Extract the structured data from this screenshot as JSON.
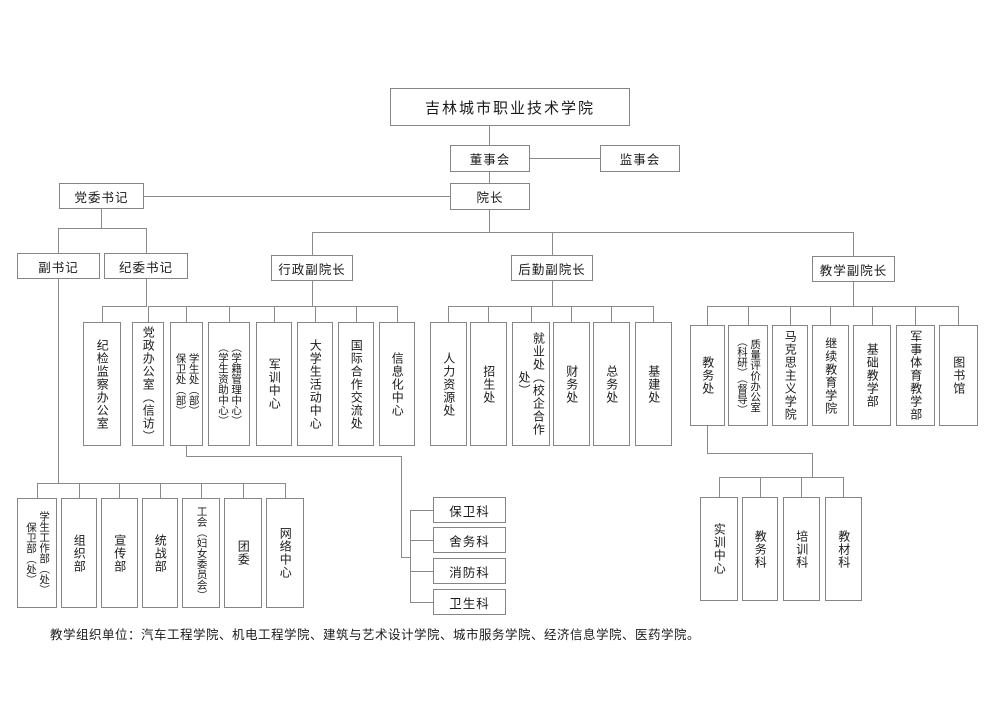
{
  "title": "吉林城市职业技术学院",
  "colors": {
    "line": "#8a8a8a",
    "text": "#1a1a1a",
    "background": "#ffffff"
  },
  "top": {
    "board": "董事会",
    "supervisory_board": "监事会",
    "president": "院长",
    "party_secretary": "党委书记",
    "deputy_secretary": "副书记",
    "discipline_secretary": "纪委书记",
    "vp_admin": "行政副院长",
    "vp_logistics": "后勤副院长",
    "vp_teaching": "教学副院长"
  },
  "discipline_office": {
    "lines": [
      "纪检监察办公室"
    ]
  },
  "admin_row": [
    {
      "lines": [
        "党政办公室（信访）"
      ]
    },
    {
      "lines": [
        "学生处（部）",
        "保卫处（部）"
      ]
    },
    {
      "lines": [
        "（学籍管理中心）",
        "（学生资助中心）"
      ]
    },
    {
      "lines": [
        "军训中心"
      ]
    },
    {
      "lines": [
        "大学生活动中心"
      ]
    },
    {
      "lines": [
        "国际合作交流处"
      ]
    },
    {
      "lines": [
        "信息化中心"
      ]
    }
  ],
  "logistics_row": [
    {
      "lines": [
        "人力资源处"
      ]
    },
    {
      "lines": [
        "招生处"
      ]
    },
    {
      "lines": [
        "就业处（校企合作处）"
      ]
    },
    {
      "lines": [
        "财务处"
      ]
    },
    {
      "lines": [
        "总务处"
      ]
    },
    {
      "lines": [
        "基建处"
      ]
    }
  ],
  "teaching_row": [
    {
      "lines": [
        "教务处"
      ]
    },
    {
      "lines": [
        "质量评价办公室",
        "（科研）（督导）"
      ]
    },
    {
      "lines": [
        "马克思主义学院"
      ]
    },
    {
      "lines": [
        "继续教育学院"
      ]
    },
    {
      "lines": [
        "基础教学部"
      ]
    },
    {
      "lines": [
        "军事体育教学部"
      ]
    },
    {
      "lines": [
        "图书馆"
      ]
    }
  ],
  "party_row": [
    {
      "lines": [
        "学生工作部（处）",
        "保卫部（处）"
      ]
    },
    {
      "lines": [
        "组织部"
      ]
    },
    {
      "lines": [
        "宣传部"
      ]
    },
    {
      "lines": [
        "统战部"
      ]
    },
    {
      "lines": [
        "工会（妇女委员会）"
      ]
    },
    {
      "lines": [
        "团委"
      ]
    },
    {
      "lines": [
        "网络中心"
      ]
    }
  ],
  "security_sections": [
    {
      "label": "保卫科"
    },
    {
      "label": "舍务科"
    },
    {
      "label": "消防科"
    },
    {
      "label": "卫生科"
    }
  ],
  "academic_sections": [
    {
      "lines": [
        "实训中心"
      ]
    },
    {
      "lines": [
        "教务科"
      ]
    },
    {
      "lines": [
        "培训科"
      ]
    },
    {
      "lines": [
        "教材科"
      ]
    }
  ],
  "caption": "教学组织单位：汽车工程学院、机电工程学院、建筑与艺术设计学院、城市服务学院、经济信息学院、医药学院。"
}
